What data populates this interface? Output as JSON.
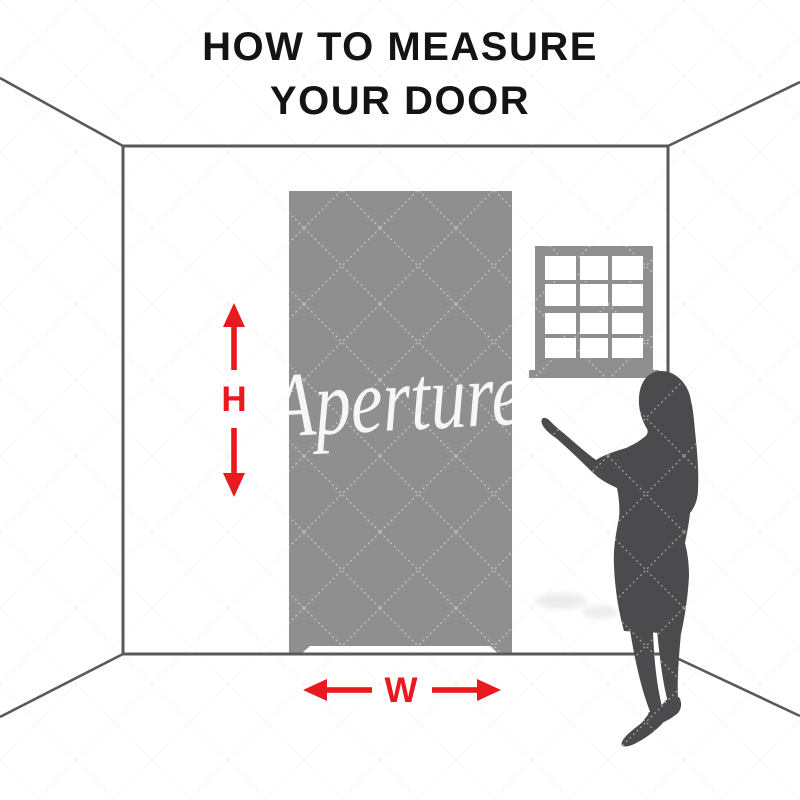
{
  "title": {
    "line1": "HOW TO MEASURE",
    "line2": "YOUR DOOR"
  },
  "measurements": {
    "height_label": "H",
    "width_label": "W"
  },
  "watermark": {
    "brand_text": "Aperture"
  },
  "icons": {
    "height_arrows": "red-double-vertical-measure-arrows",
    "width_arrows": "red-double-horizontal-measure-arrows",
    "window_icon": "twelve-pane-sash-window",
    "silhouette_icon": "standing-woman-silhouette"
  },
  "colors": {
    "arrow_red": "#e8191f",
    "door_gray": "#8f8f8f",
    "window_gray": "#8f8f8f",
    "silhouette_gray": "#4b4b4d",
    "wall_line": "#595959",
    "background": "#ffffff",
    "watermark_white": "#ffffff"
  }
}
